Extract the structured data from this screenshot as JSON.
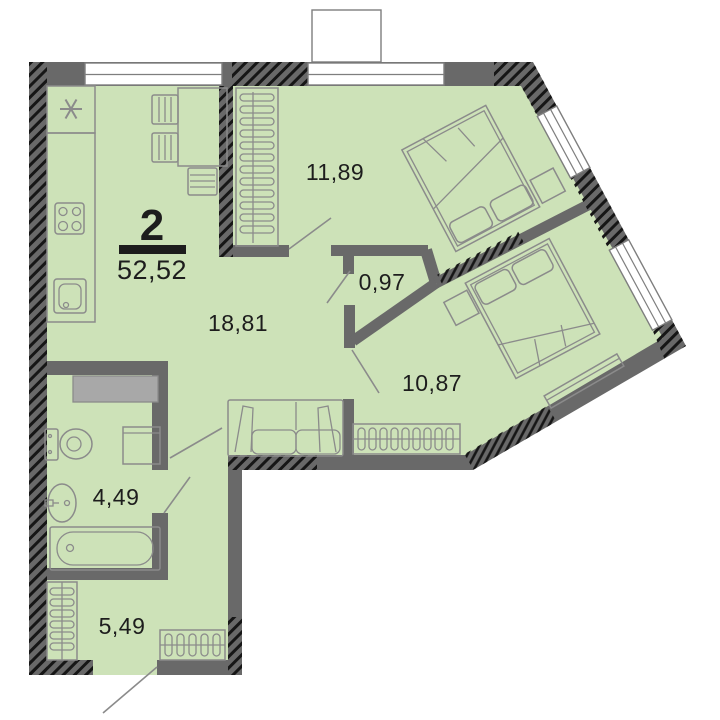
{
  "floorplan": {
    "apartment": {
      "rooms_count": "2",
      "total_area": "52,52"
    },
    "rooms": [
      {
        "id": "bedroom-1",
        "area": "11,89"
      },
      {
        "id": "closet",
        "area": "0,97"
      },
      {
        "id": "living-kitchen",
        "area": "18,81"
      },
      {
        "id": "bedroom-2",
        "area": "10,87"
      },
      {
        "id": "bathroom",
        "area": "4,49"
      },
      {
        "id": "hallway",
        "area": "5,49"
      }
    ],
    "icons": {
      "ventilation_shaft_symbol": "asterisk-6-spoke",
      "radiator_symbol": "coil-loops",
      "wardrobe_symbol": "hanger-loops"
    },
    "colors": {
      "floor": "#cde2b8",
      "wall": "#696969",
      "outline": "#8b8b8b",
      "text": "#1d1d1d",
      "shaft": "#a8a8a8",
      "window": "#ffffff"
    }
  }
}
